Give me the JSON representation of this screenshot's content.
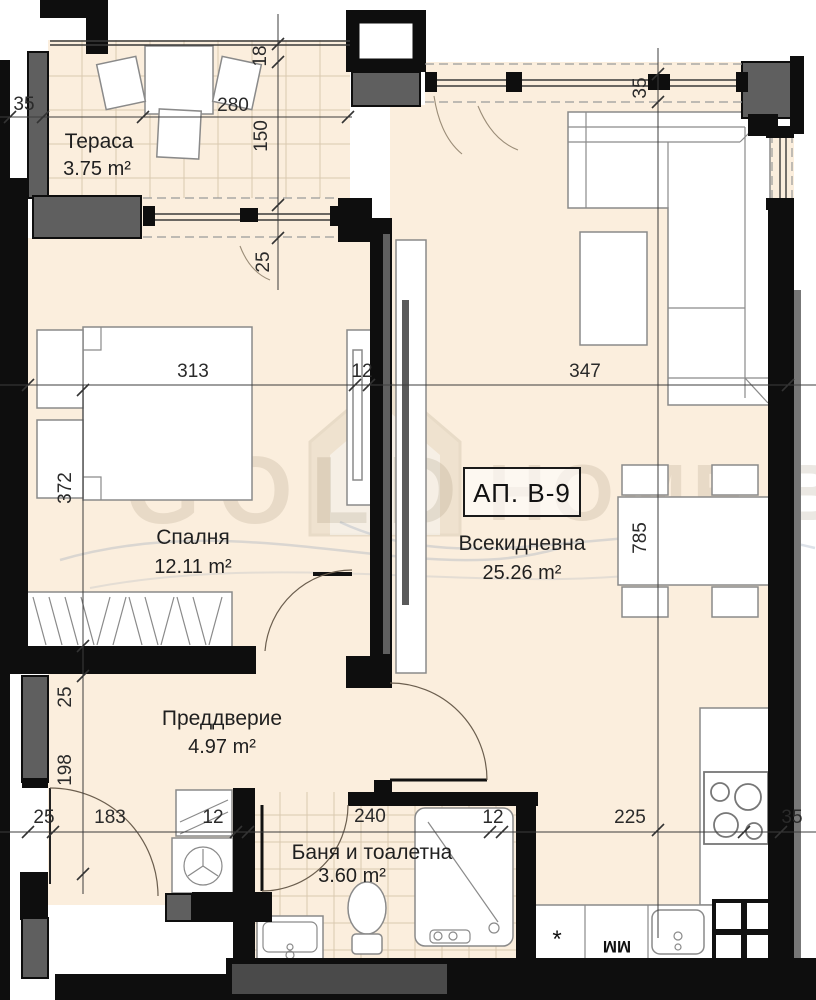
{
  "apartment": {
    "label": "АП. В-9"
  },
  "rooms": {
    "terrace": {
      "name": "Тераса",
      "area": "3.75 m²"
    },
    "bedroom": {
      "name": "Спалня",
      "area": "12.11 m²"
    },
    "living": {
      "name": "Всекидневна",
      "area": "25.26 m²"
    },
    "hall": {
      "name": "Преддверие",
      "area": "4.97 m²"
    },
    "bath": {
      "name": "Баня и тоалетна",
      "area": "3.60 m²"
    }
  },
  "dims": {
    "terrace_wall_35": "35",
    "terrace_width_280": "280",
    "terrace_win_18": "18",
    "terrace_win_150": "150",
    "terrace_win_25": "25",
    "living_win_35": "35",
    "bedroom_width_313": "313",
    "mid_wall_12": "12",
    "living_width_347": "347",
    "bedroom_depth_372": "372",
    "living_depth_785": "785",
    "hall_left_25": "25",
    "hall_left_198": "198",
    "bottom_25": "25",
    "bottom_183": "183",
    "bottom_12_left": "12",
    "bottom_240": "240",
    "bottom_12_right": "12",
    "bottom_225": "225",
    "bottom_35": "35"
  },
  "appliances": {
    "dishwasher_mark": "*",
    "washing_machine_mark": "ММ"
  },
  "watermark": {
    "word_left": "GOLD",
    "word_right": "HOME.BG"
  },
  "colors": {
    "floor": "#fbeedd",
    "wall": "#0e0e0e",
    "concrete": "#5f5f5f"
  }
}
